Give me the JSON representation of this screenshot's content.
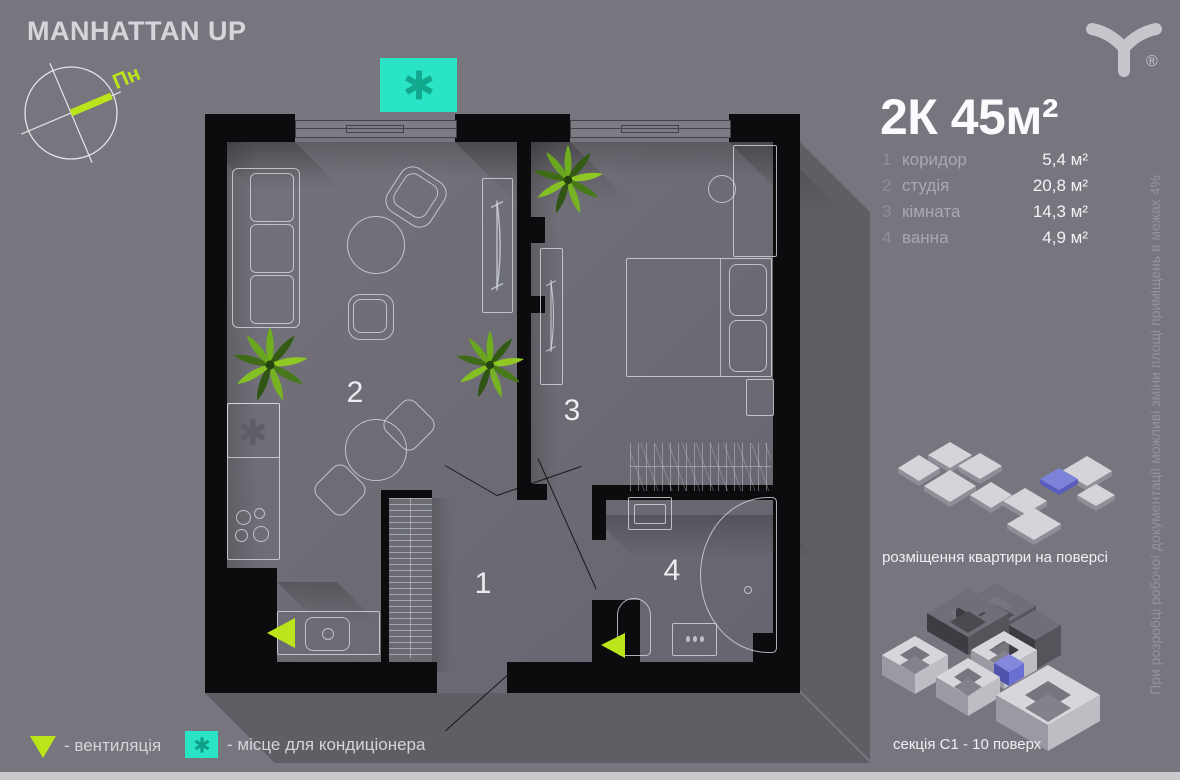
{
  "brand": {
    "title": "MANHATTAN UP",
    "registered": "®"
  },
  "compass": {
    "north_label": "Пн"
  },
  "apartment": {
    "title": "2К 45м²",
    "rooms": [
      {
        "num": "1",
        "name": "коридор",
        "area": "5,4 м²"
      },
      {
        "num": "2",
        "name": "студія",
        "area": "20,8 м²"
      },
      {
        "num": "3",
        "name": "кімната",
        "area": "14,3 м²"
      },
      {
        "num": "4",
        "name": "ванна",
        "area": "4,9 м²"
      }
    ]
  },
  "plan": {
    "room_labels": [
      "1",
      "2",
      "3",
      "4"
    ]
  },
  "legend": {
    "vent": "- вентиляція",
    "ac": "- місце для кондиціонера"
  },
  "diagrams": {
    "floor_caption": "розміщення квартири на поверсі",
    "section_caption": "секція С1 - 10 поверх"
  },
  "disclaimer": "При розробці робочої документації можливі зміни площі приміщень в межах 4%",
  "colors": {
    "background": "#77767e",
    "accent_lime": "#bce41a",
    "accent_teal": "#2ae5c5",
    "highlight_purple": "#8287db",
    "wall_black": "#0c0c0f"
  }
}
